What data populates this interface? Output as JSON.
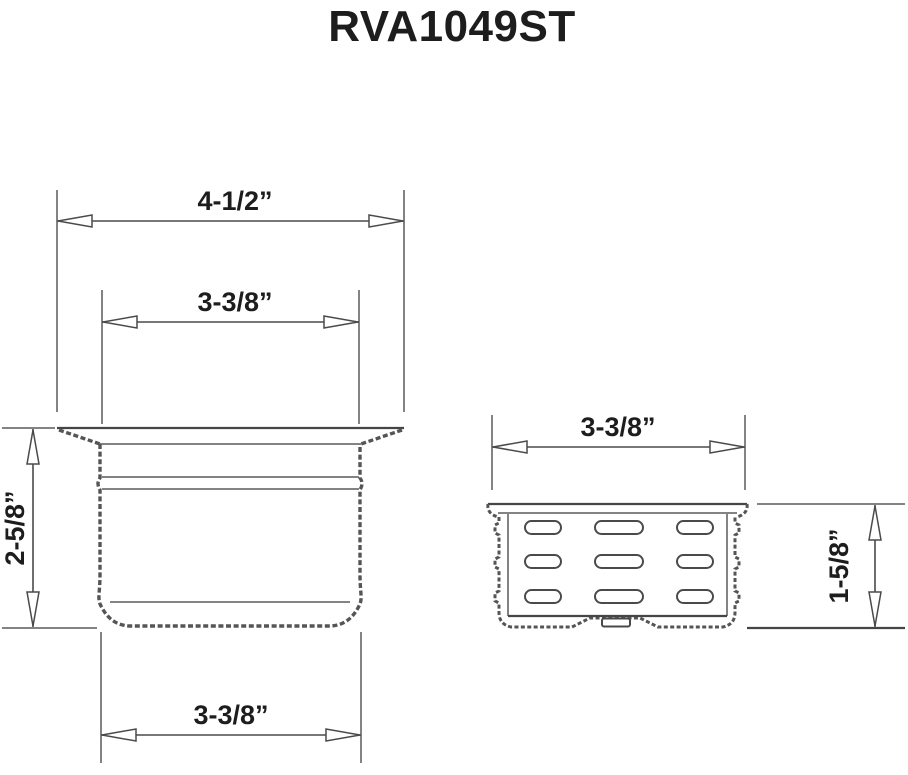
{
  "title": "RVA1049ST",
  "colors": {
    "line": "#4a4a4a",
    "hatch_line": "#555555",
    "text": "#1d1d1d",
    "background": "#ffffff"
  },
  "left_view": {
    "name": "strainer-body-side-section",
    "dimensions": {
      "flange_width": "4-1/2”",
      "body_width_top": "3-3/8”",
      "height": "2-5/8”",
      "body_width_bottom": "3-3/8”"
    }
  },
  "right_view": {
    "name": "basket-side-view",
    "dimensions": {
      "width": "3-3/8”",
      "height": "1-5/8”"
    }
  }
}
